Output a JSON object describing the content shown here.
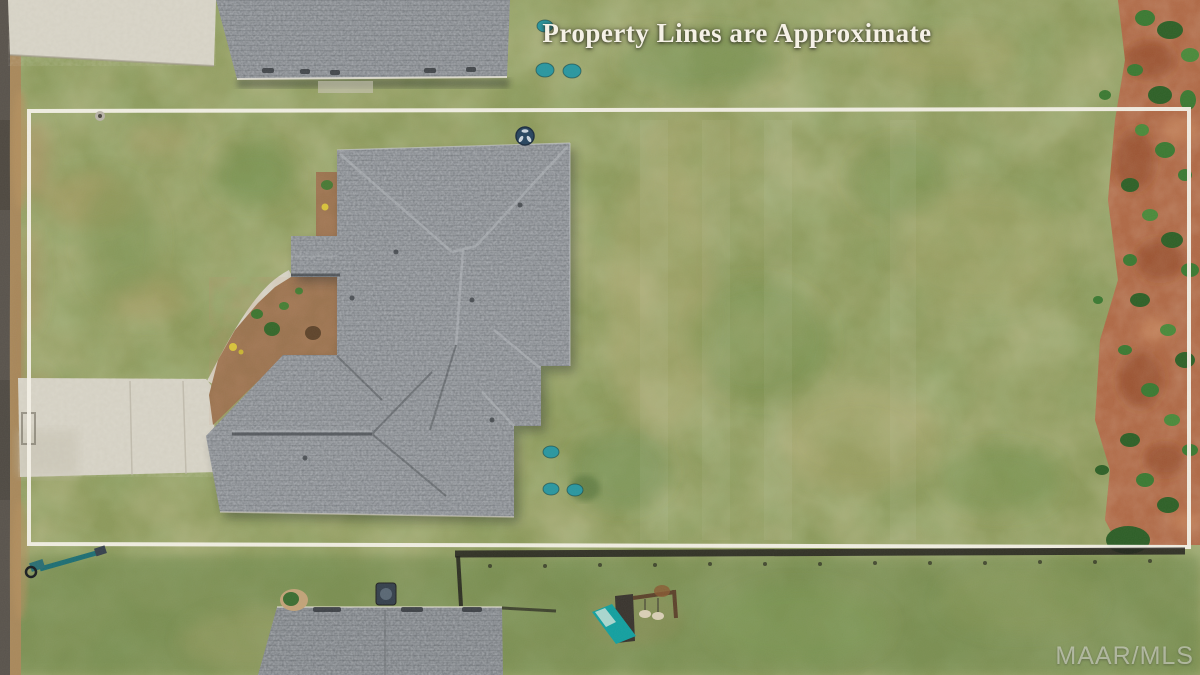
{
  "photo": {
    "overlay_caption": "Property Lines are Approximate",
    "watermark": "MAAR/MLS"
  },
  "colors": {
    "boundary_line": "#f4f1e8",
    "caption_text": "#f5f1e6",
    "watermark_text": "rgba(230,230,224,0.55)",
    "grass_green": "#8d9a5c",
    "roof_gray": "#84888d",
    "dirt_red": "#b06a47",
    "concrete": "#d5d1c4",
    "teal_marker": "#2b97a0",
    "mulch_brown": "#9b7450",
    "road_asphalt": "#5a544d",
    "fence_dark": "#23211d"
  }
}
